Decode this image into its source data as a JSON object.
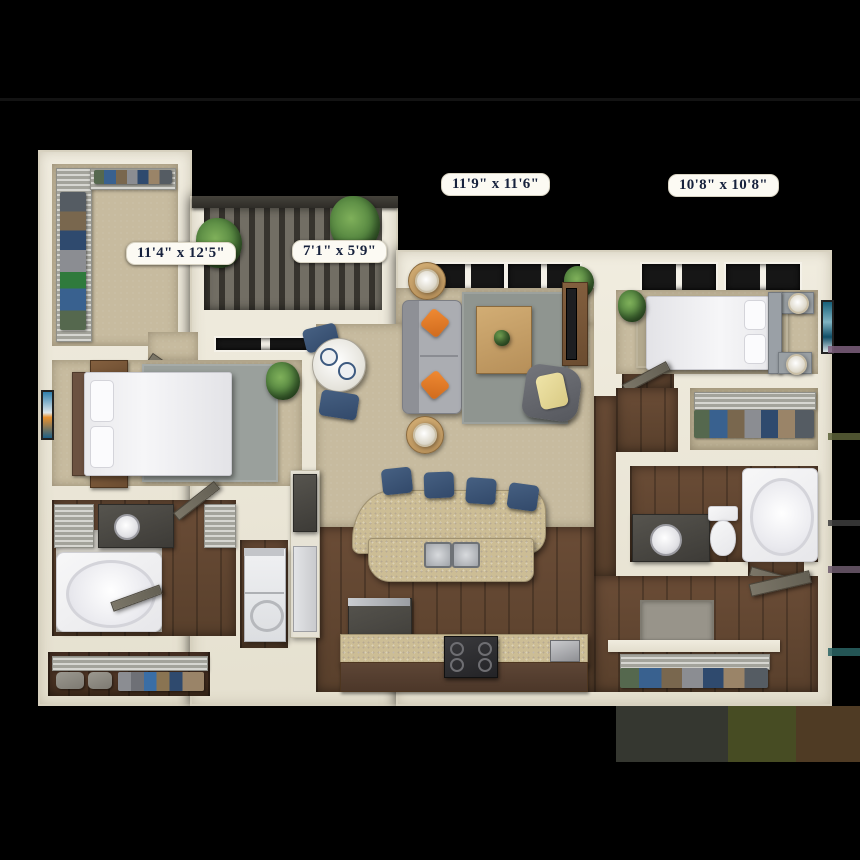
{
  "scene": {
    "kind": "3d-apartment-floorplan-render",
    "background_color": "#000000",
    "units": "feet-inches"
  },
  "dimension_labels": {
    "living_room": "11'9\" x 11'6\"",
    "bedroom_right": "10'8\" x 10'8\"",
    "bedroom_left": "11'4\" x 12'5\"",
    "patio": "7'1\" x 5'9\""
  },
  "palette": {
    "wall": "#ece8db",
    "carpet": "#c7bb9f",
    "wood_floor": "#5f4633",
    "patio_deck": "#4a4741",
    "rug_gray": "#8f9590",
    "sofa_gray": "#a8aaaf",
    "pillow_orange": "#e0782a",
    "stool_navy": "#3c5471",
    "counter_granite": "#ccbd95",
    "cabinet_charcoal": "#46443f",
    "door_gray": "#716c5e",
    "plant_green": "#4e7f3c",
    "bed_white": "#f2f2f4",
    "throw_yellow": "#e9dd9b",
    "label_text": "#17223d",
    "label_background": "#fcfaf3"
  },
  "rooms": [
    "walk-in-closet-top-left",
    "patio",
    "bedroom-left",
    "living-room",
    "dining-nook",
    "bedroom-right",
    "closet-right",
    "bathroom-right",
    "kitchen",
    "bathroom-left",
    "laundry",
    "walk-in-closet-bottom-left",
    "entry-hall",
    "coat-closet"
  ]
}
